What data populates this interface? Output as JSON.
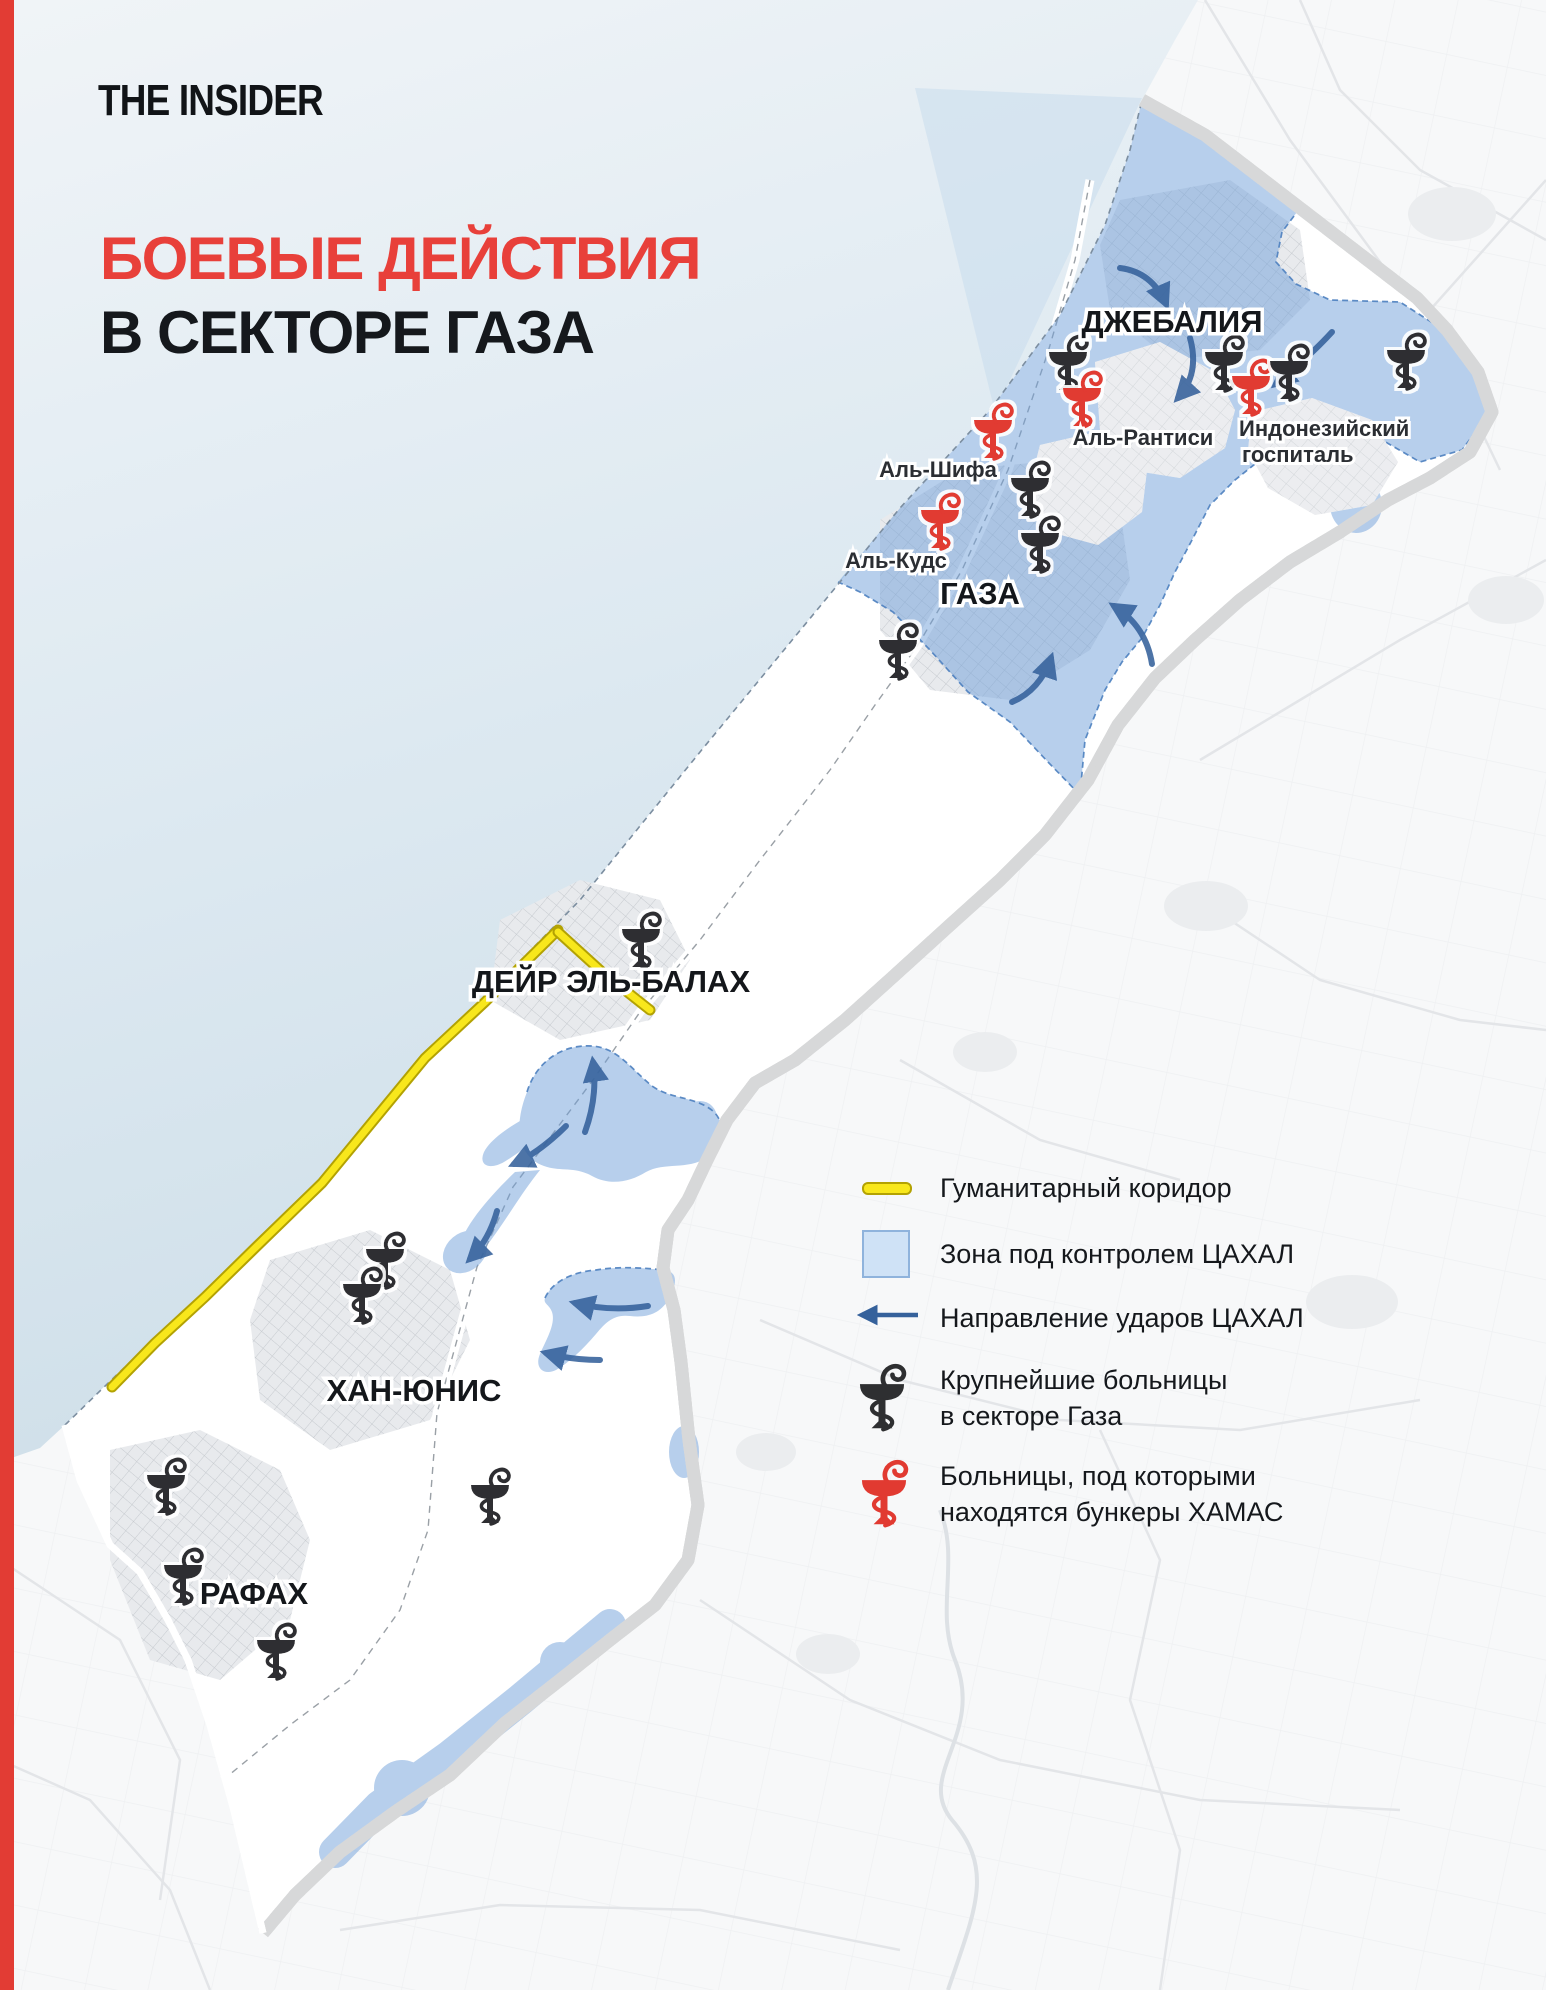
{
  "brand": {
    "logo_text": "THE INSIDER"
  },
  "title": {
    "line1": "БОЕВЫЕ ДЕЙСТВИЯ",
    "line2": "В СЕКТОРЕ ГАЗА"
  },
  "map": {
    "city_labels": {
      "jabalia": "ДЖЕБАЛИЯ",
      "gaza": "ГАЗА",
      "deir_el_balah": "ДЕЙР ЭЛЬ-БАЛАХ",
      "khan_yunis": "ХАН-ЮНИС",
      "rafah": "РАФАХ"
    },
    "hospital_labels": {
      "al_shifa": "Аль-Шифа",
      "al_quds": "Аль-Кудс",
      "al_rantisi": "Аль-Рантиси",
      "indonesian_line1": "Индонезийский",
      "indonesian_line2": "госпиталь"
    }
  },
  "legend": {
    "humanitarian_corridor": "Гуманитарный коридор",
    "idf_zone": "Зона под контролем ЦАХАЛ",
    "idf_strikes": "Направление ударов ЦАХАЛ",
    "hospitals_line1": "Крупнейшие больницы",
    "hospitals_line2": "в секторе Газа",
    "bunker_hospitals_line1": "Больницы, под которыми",
    "bunker_hospitals_line2": "находятся бункеры ХАМАС"
  },
  "colors": {
    "accent_red": "#e23c34",
    "title_red": "#e8403a",
    "zone_blue_fill": "#bdd4ee",
    "zone_blue_border": "#4c80bf",
    "arrow_blue": "#35619b",
    "corridor_yellow": "#f8e71c",
    "sea": "#d7e4ee"
  }
}
